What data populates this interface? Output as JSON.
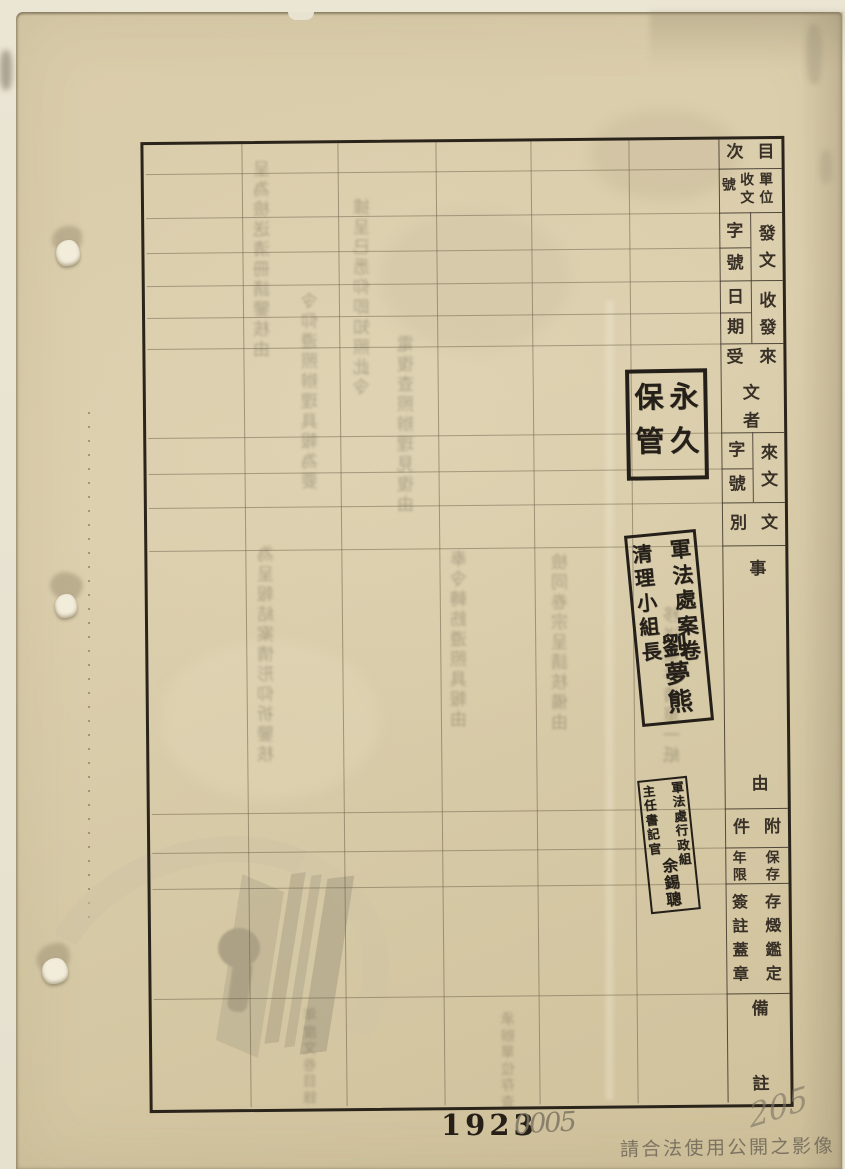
{
  "colors": {
    "paper": "#d9ccaa",
    "scan_bed": "#e8e2d1",
    "grid_line_faint": "#6c6049",
    "border_ink": "#2b241b",
    "label_ink": "#393127",
    "stamp_ink": "#241f18",
    "pencil_gray": "#7d7464",
    "watermark_gray": "#766c5c"
  },
  "ledger": {
    "headers": {
      "item_number": {
        "right": "目",
        "left": "次"
      },
      "unit_receipt_no": {
        "col_right": "單位",
        "col_mid": "收文",
        "col_left": "號"
      },
      "dispatch_no": {
        "main": "發文",
        "sub_top": "字",
        "sub_bottom": "號"
      },
      "send_receive_date": {
        "main": "收發",
        "sub_top": "日",
        "sub_bottom": "期"
      },
      "correspondent": {
        "top_right": "來",
        "top_left": "受",
        "mid": "文",
        "bottom": "者"
      },
      "incoming_doc_no": {
        "main": "來文",
        "sub_top": "字",
        "sub_bottom": "號"
      },
      "doc_type": {
        "right": "文",
        "left": "別"
      },
      "subject": {
        "top": "事",
        "bottom": "由"
      },
      "attachments": {
        "right": "附",
        "left": "件"
      },
      "retention_period": {
        "right": "保存",
        "left": "年限"
      },
      "appraisal": {
        "right": "存燬鑑定",
        "left": "簽註蓋章"
      },
      "remarks": {
        "top": "備",
        "bottom": "註"
      }
    }
  },
  "stamps": {
    "permanent_retention": {
      "right_column": "永久",
      "left_column": "保管"
    },
    "case_clearing_team": {
      "right_column": "軍法處案卷",
      "left_column": "清理小組長",
      "name": "劉夢熊"
    },
    "chief_clerk": {
      "right_column": "軍法處行政組",
      "left_column": "主任書記官",
      "name": "余錫聰"
    }
  },
  "footer": {
    "page_number": "1923",
    "handwritten_number": "0005",
    "pencil_scribble": "205",
    "watermark_notice": "請合法使用公開之影像"
  },
  "decor": {
    "illegible_bleedthrough_filler": [
      "呈為檢送清冊請鑒核由",
      "令仰遵照辦理具報為要",
      "據呈已悉仰即知照此令",
      "電復查照辦理見復由",
      "為呈報結案情形仰祈鑒核",
      "奉令轉飭遵照具報由",
      "檢同卷宗呈請核備由",
      "移送案件清單一紙",
      "年度文卷目錄",
      "承辦單位存查"
    ]
  }
}
